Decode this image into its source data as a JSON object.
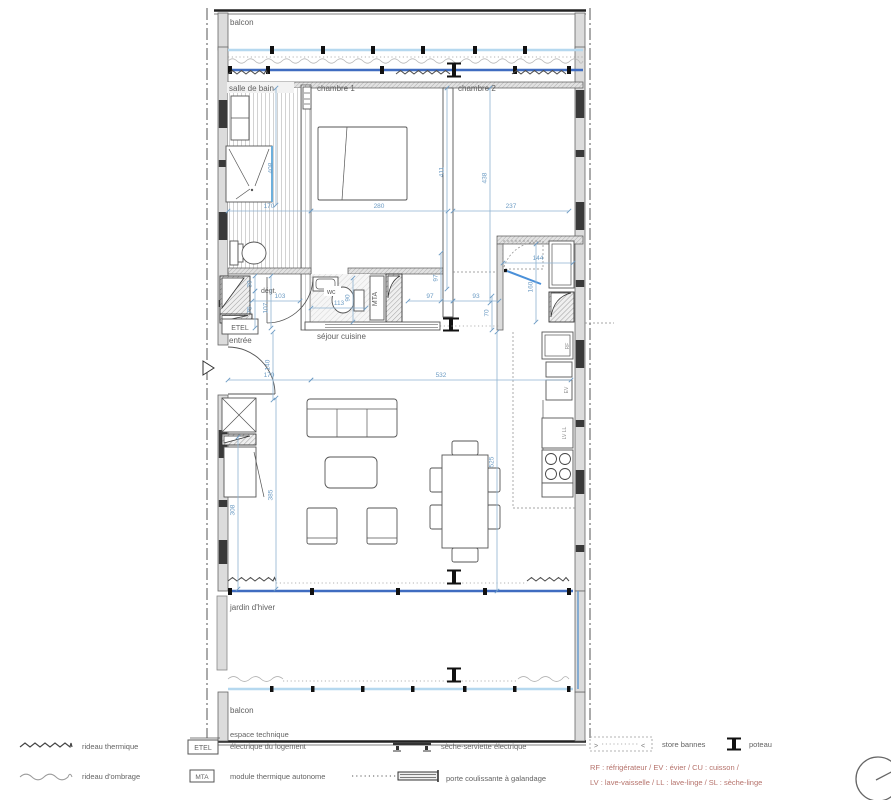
{
  "rooms": {
    "balcon_top": "balcon",
    "salle_de_bain": "salle de bain",
    "chambre1": "chambre 1",
    "chambre2": "chambre 2",
    "degagement": "dégt.",
    "wc": "wc",
    "entree": "entrée",
    "sejour": "séjour cuisine",
    "jardin": "jardin d'hiver",
    "balcon_bottom": "balcon"
  },
  "boxes": {
    "etel": "ETEL",
    "mta": "MTA"
  },
  "kitchen": {
    "rf": "RF",
    "ev": "EV",
    "lvll": "LV LL"
  },
  "dims": {
    "bath_w": "170",
    "ch1_w": "280",
    "ch2_w": "237",
    "bath_h": "408",
    "ch1_h": "411",
    "ch2_h": "438",
    "closet_30": "30",
    "closet_75": "75",
    "degt_w": "103",
    "degt_h": "107",
    "wc_w": "113",
    "wc_h": "90",
    "pass_w1": "97",
    "pass_h1": "97",
    "pass_w2": "93",
    "pass_h2": "70",
    "entry_w": "144",
    "entry_h": "160",
    "door_h": "140",
    "sejour_170": "170",
    "sejour_w": "532",
    "sejour_h": "525",
    "left_h": "385",
    "closet_h": "308"
  },
  "legend": {
    "rideau_thermique": "rideau thermique",
    "rideau_ombrage": "rideau d'ombrage",
    "etel_line1": "espace technique",
    "etel_line2": "électrique du logement",
    "etel_tag": "ETEL",
    "mta_tag": "MTA",
    "mta": "module thermique autonome",
    "seche_serviette": "sèche-serviette électrique",
    "porte_coulissante": "porte coulissante à galandage",
    "store_bannes": "store bannes",
    "store_left": ">",
    "store_right": "<",
    "poteau": "poteau",
    "abbrev_line1": "RF : réfrigérateur / EV : évier / CU : cuisson /",
    "abbrev_line2": "LV : lave-vaisselle / LL : lave-linge / SL : sèche-linge"
  },
  "colors": {
    "dim_text": "#6d9cc4",
    "glazing_dark": "#3f6cc0",
    "glazing_light": "#b5d8ef",
    "abbrev_red": "#b5726b",
    "sliding_blue": "#4a90d9"
  }
}
